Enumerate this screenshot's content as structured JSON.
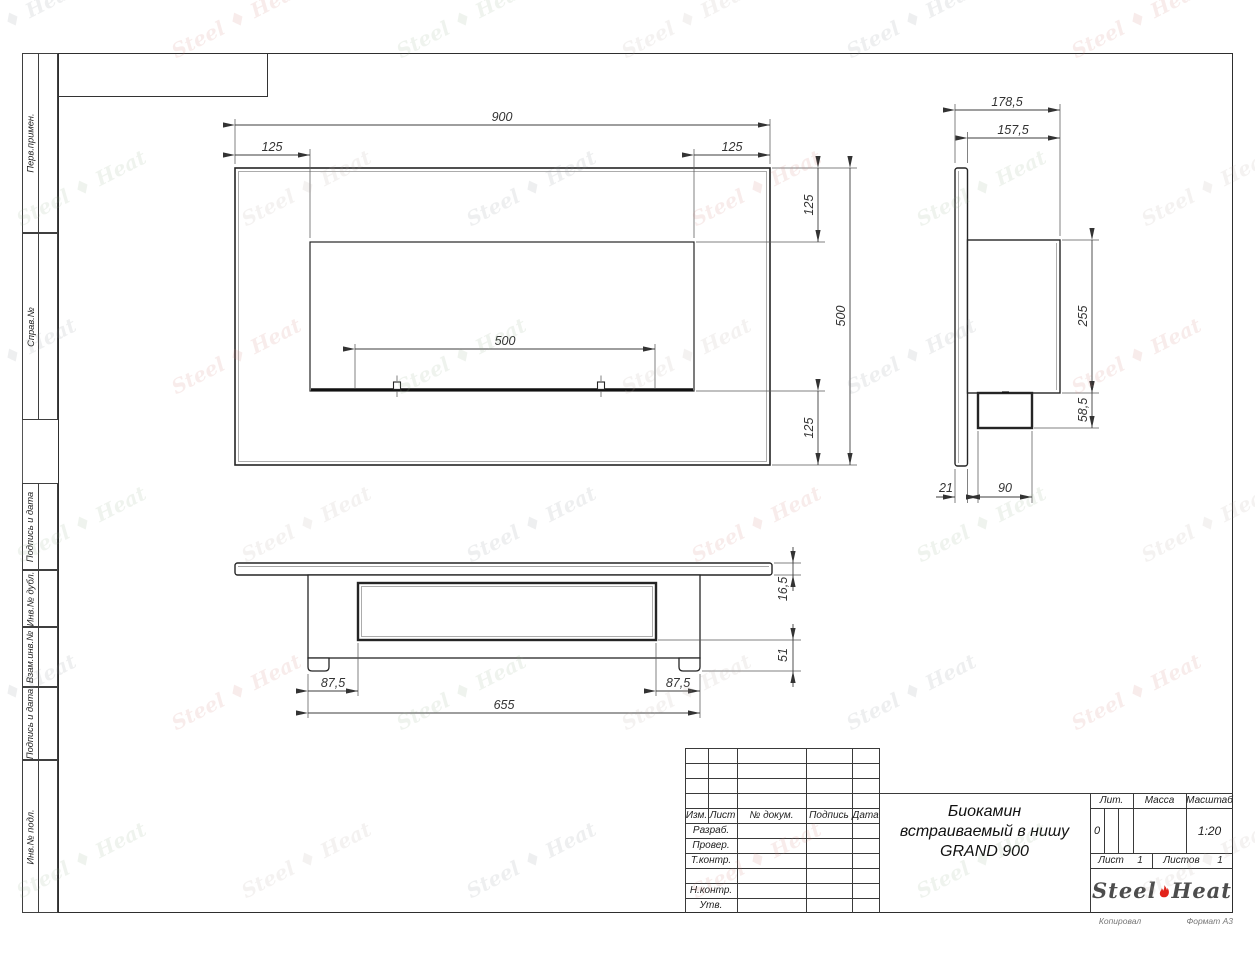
{
  "page": {
    "watermark": {
      "steel": "Steel",
      "heat": "Heat",
      "colors": [
        "#8f959b",
        "#cf8079",
        "#93b28d",
        "#b9a9a2"
      ]
    },
    "below_frame": {
      "copied": "Копировал",
      "format": "Формат А3"
    }
  },
  "sidebar": {
    "sections": [
      {
        "label": "Перв.примен."
      },
      {
        "label": "Справ.№"
      },
      {
        "label": "Подпись и дата"
      },
      {
        "label": "Инв.№ дубл."
      },
      {
        "label": "Взам.инв.№"
      },
      {
        "label": "Подпись и дата"
      },
      {
        "label": "Инв.№ подл."
      }
    ]
  },
  "title_block": {
    "revision_headers": [
      "Изм.",
      "Лист",
      "№ докум.",
      "Подпись",
      "Дата"
    ],
    "signature_rows": [
      "Разраб.",
      "Провер.",
      "Т.контр.",
      "Н.контр.",
      "Утв."
    ],
    "title_lines": [
      "Биокамин",
      "встраиваемый в нишу",
      "GRAND 900"
    ],
    "lit": {
      "label": "Лит.",
      "value": "0"
    },
    "mass": {
      "label": "Масса",
      "value": ""
    },
    "scale": {
      "label": "Масштаб",
      "value": "1:20"
    },
    "sheet": {
      "label": "Лист",
      "value": "1"
    },
    "sheets": {
      "label": "Листов",
      "value": "1"
    },
    "logo": {
      "steel": "Steel",
      "heat": "Heat",
      "flame_color": "#e2231a",
      "text_color": "#4d4d4d"
    }
  },
  "drawing": {
    "front_view": {
      "dims": {
        "overall_width": "900",
        "left_margin": "125",
        "right_margin": "125",
        "top_margin": "125",
        "overall_height": "500",
        "bottom_margin": "125",
        "burner_width": "500"
      }
    },
    "side_view": {
      "dims": {
        "total_depth": "178,5",
        "box_depth": "157,5",
        "box_height": "255",
        "lower_box_height": "58,5",
        "panel_thickness": "21",
        "lower_box_depth": "90"
      }
    },
    "bottom_view": {
      "dims": {
        "left_offset": "87,5",
        "right_offset": "87,5",
        "body_width": "655",
        "plate_thickness": "16,5",
        "body_depth": "51"
      }
    }
  }
}
